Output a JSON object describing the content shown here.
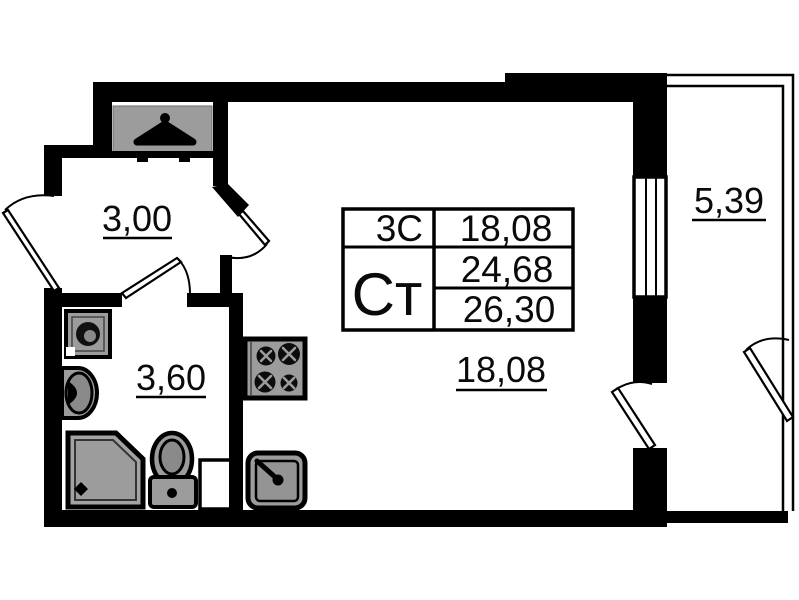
{
  "stamp": {
    "rooms_code": "3С",
    "living_area": "18,08",
    "type_code": "Ст",
    "area_total": "24,68",
    "area_total_with_balcony": "26,30"
  },
  "rooms": {
    "hallway": {
      "name": "hallway",
      "area": "3,00"
    },
    "bathroom": {
      "name": "bathroom",
      "area": "3,60"
    },
    "living": {
      "name": "living-kitchen",
      "area": "18,08"
    },
    "balcony": {
      "name": "balcony",
      "area": "5,39"
    }
  },
  "fixtures": [
    "wardrobe-hanger",
    "washing-machine",
    "bathroom-sink",
    "shower-tray",
    "toilet",
    "stove-4-burner",
    "kitchen-sink",
    "vent-shaft"
  ],
  "colors": {
    "wall": "#000000",
    "fixture_fill": "#9c9c9c",
    "fixture_inner": "#8a8a8a",
    "background": "#ffffff"
  }
}
